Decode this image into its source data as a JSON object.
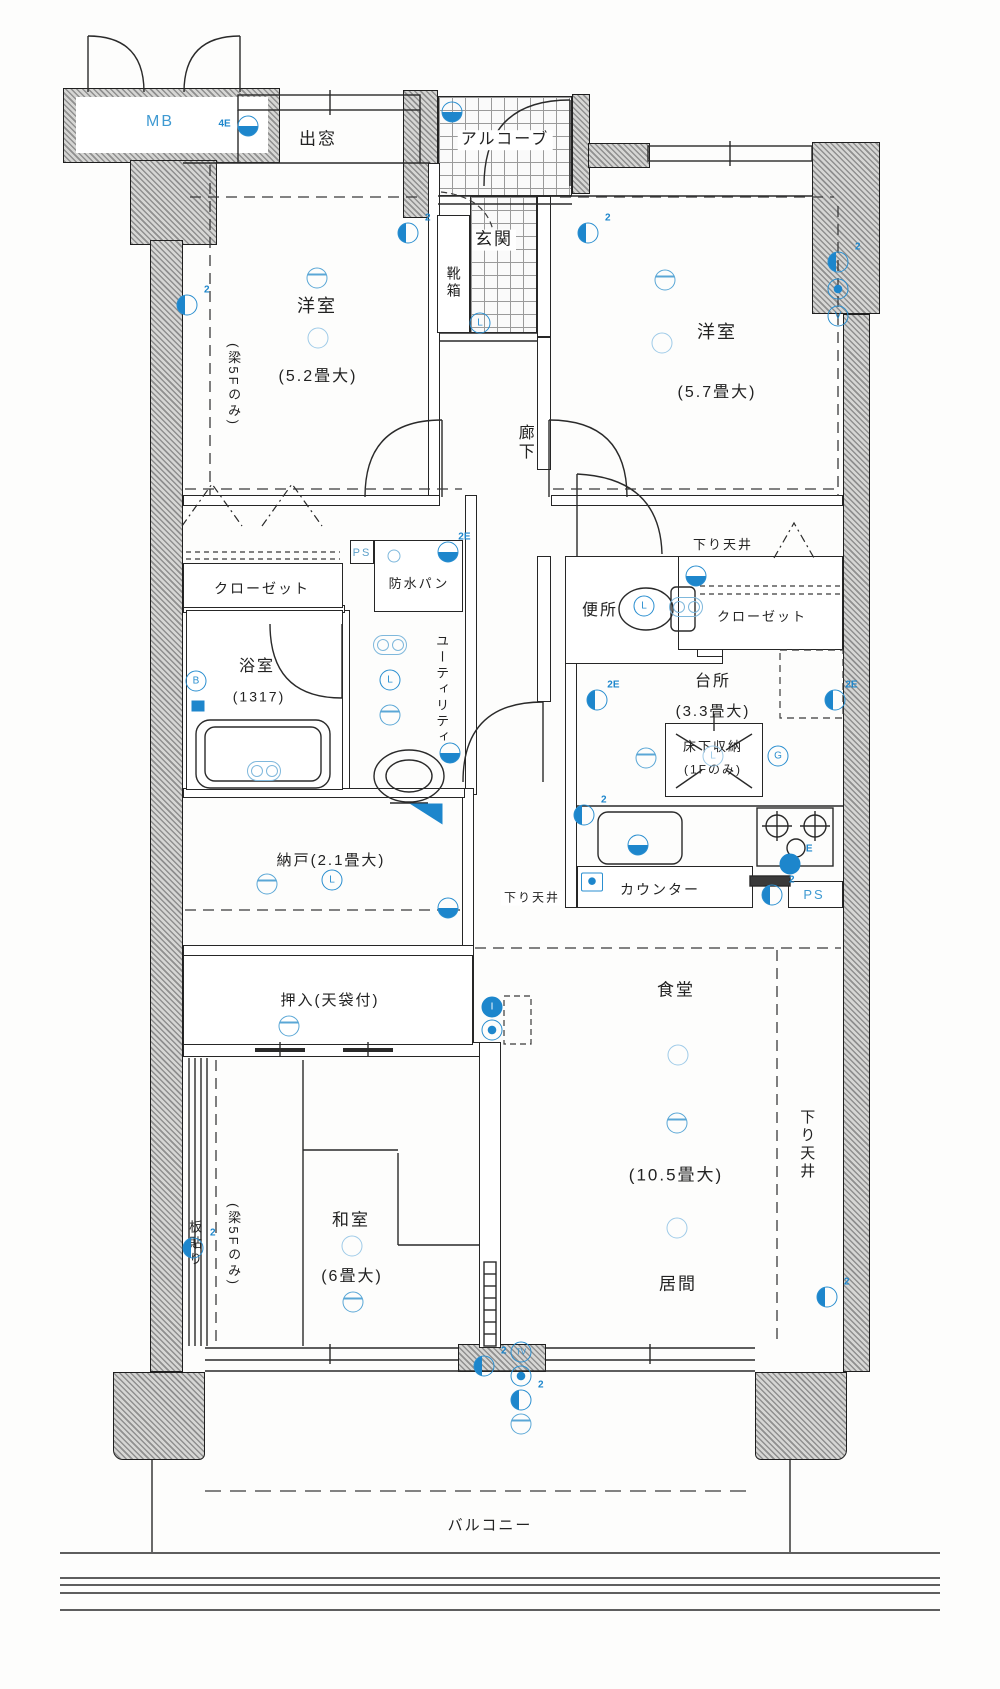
{
  "title": "マンション間取り図",
  "colors": {
    "symbol_blue": "#1d86cc",
    "light_blue": "#9fcbe8",
    "line": "#262626",
    "wall": "#8f8f8f",
    "ps_blue": "#3f9ad2"
  },
  "labels": [
    {
      "name": "label-mb",
      "text": "MB",
      "x": 160,
      "y": 122,
      "fs": 16,
      "v": false,
      "bg": false,
      "color": "#3f9ad2"
    },
    {
      "name": "label-bay-window",
      "text": "出窓",
      "x": 318,
      "y": 140,
      "fs": 17,
      "v": false,
      "bg": false,
      "color": ""
    },
    {
      "name": "label-alcove",
      "text": "アルコーブ",
      "x": 505,
      "y": 140,
      "fs": 16,
      "v": false,
      "bg": true,
      "color": ""
    },
    {
      "name": "label-genkan",
      "text": "玄関",
      "x": 494,
      "y": 240,
      "fs": 17,
      "v": false,
      "bg": true,
      "color": ""
    },
    {
      "name": "label-shoebox",
      "text": "靴箱",
      "x": 453,
      "y": 283,
      "fs": 14,
      "v": true,
      "bg": false,
      "color": ""
    },
    {
      "name": "label-western-room-1",
      "text": "洋室",
      "x": 317,
      "y": 307,
      "fs": 18,
      "v": false,
      "bg": false,
      "color": ""
    },
    {
      "name": "label-western-room-1-size",
      "text": "(5.2畳大)",
      "x": 318,
      "y": 377,
      "fs": 16,
      "v": false,
      "bg": false,
      "color": ""
    },
    {
      "name": "label-beam-5f-1",
      "text": "(梁5Fのみ)",
      "x": 233,
      "y": 385,
      "fs": 13,
      "v": true,
      "bg": false,
      "color": ""
    },
    {
      "name": "label-corridor",
      "text": "廊下",
      "x": 524,
      "y": 443,
      "fs": 16,
      "v": true,
      "bg": false,
      "color": ""
    },
    {
      "name": "label-western-room-2",
      "text": "洋室",
      "x": 717,
      "y": 333,
      "fs": 18,
      "v": false,
      "bg": false,
      "color": ""
    },
    {
      "name": "label-western-room-2-size",
      "text": "(5.7畳大)",
      "x": 717,
      "y": 393,
      "fs": 16,
      "v": false,
      "bg": false,
      "color": ""
    },
    {
      "name": "label-closet-left",
      "text": "クローゼット",
      "x": 262,
      "y": 589,
      "fs": 14,
      "v": false,
      "bg": false,
      "color": ""
    },
    {
      "name": "label-ps-1",
      "text": "PS",
      "x": 362,
      "y": 553,
      "fs": 11,
      "v": false,
      "bg": false,
      "color": "#5b9fc9"
    },
    {
      "name": "label-waterproof-pan",
      "text": "防水パン",
      "x": 419,
      "y": 584,
      "fs": 13,
      "v": false,
      "bg": true,
      "color": ""
    },
    {
      "name": "label-utility",
      "text": "ユーティリティ",
      "x": 441,
      "y": 690,
      "fs": 13,
      "v": true,
      "bg": false,
      "color": ""
    },
    {
      "name": "label-bathroom",
      "text": "浴室",
      "x": 257,
      "y": 667,
      "fs": 16,
      "v": false,
      "bg": false,
      "color": ""
    },
    {
      "name": "label-bathroom-size",
      "text": "(1317)",
      "x": 259,
      "y": 697,
      "fs": 14,
      "v": false,
      "bg": false,
      "color": ""
    },
    {
      "name": "label-toilet",
      "text": "便所",
      "x": 600,
      "y": 611,
      "fs": 16,
      "v": false,
      "bg": false,
      "color": ""
    },
    {
      "name": "label-lowered-ceiling-1",
      "text": "下り天井",
      "x": 723,
      "y": 545,
      "fs": 13,
      "v": false,
      "bg": false,
      "color": ""
    },
    {
      "name": "label-closet-right",
      "text": "クローゼット",
      "x": 762,
      "y": 617,
      "fs": 13,
      "v": false,
      "bg": false,
      "color": ""
    },
    {
      "name": "label-kitchen",
      "text": "台所",
      "x": 713,
      "y": 682,
      "fs": 16,
      "v": false,
      "bg": false,
      "color": ""
    },
    {
      "name": "label-kitchen-size",
      "text": "(3.3畳大)",
      "x": 713,
      "y": 712,
      "fs": 15,
      "v": false,
      "bg": false,
      "color": ""
    },
    {
      "name": "label-underfloor-storage",
      "text": "床下収納",
      "x": 713,
      "y": 747,
      "fs": 13,
      "v": false,
      "bg": false,
      "color": ""
    },
    {
      "name": "label-underfloor-storage-2",
      "text": "(1Fのみ)",
      "x": 713,
      "y": 770,
      "fs": 12,
      "v": false,
      "bg": false,
      "color": ""
    },
    {
      "name": "label-storeroom",
      "text": "納戸(2.1畳大)",
      "x": 331,
      "y": 861,
      "fs": 15,
      "v": false,
      "bg": false,
      "color": ""
    },
    {
      "name": "label-lowered-ceiling-2",
      "text": "下り天井",
      "x": 532,
      "y": 898,
      "fs": 12,
      "v": false,
      "bg": true,
      "color": ""
    },
    {
      "name": "label-counter",
      "text": "カウンター",
      "x": 660,
      "y": 890,
      "fs": 14,
      "v": false,
      "bg": false,
      "color": ""
    },
    {
      "name": "label-ps-2",
      "text": "PS",
      "x": 814,
      "y": 895,
      "fs": 13,
      "v": false,
      "bg": false,
      "color": "#3f9ad2"
    },
    {
      "name": "label-oshiire",
      "text": "押入(天袋付)",
      "x": 330,
      "y": 1001,
      "fs": 15,
      "v": false,
      "bg": false,
      "color": ""
    },
    {
      "name": "label-wood-floor",
      "text": "板貼り",
      "x": 194,
      "y": 1244,
      "fs": 13,
      "v": true,
      "bg": false,
      "color": ""
    },
    {
      "name": "label-beam-5f-2",
      "text": "(梁5Fのみ)",
      "x": 233,
      "y": 1245,
      "fs": 13,
      "v": true,
      "bg": false,
      "color": ""
    },
    {
      "name": "label-japanese-room",
      "text": "和室",
      "x": 351,
      "y": 1221,
      "fs": 17,
      "v": false,
      "bg": false,
      "color": ""
    },
    {
      "name": "label-japanese-room-size",
      "text": "(6畳大)",
      "x": 352,
      "y": 1277,
      "fs": 16,
      "v": false,
      "bg": false,
      "color": ""
    },
    {
      "name": "label-dining",
      "text": "食堂",
      "x": 676,
      "y": 991,
      "fs": 17,
      "v": false,
      "bg": false,
      "color": ""
    },
    {
      "name": "label-ld-size",
      "text": "(10.5畳大)",
      "x": 676,
      "y": 1176,
      "fs": 17,
      "v": false,
      "bg": false,
      "color": ""
    },
    {
      "name": "label-living",
      "text": "居間",
      "x": 678,
      "y": 1285,
      "fs": 17,
      "v": false,
      "bg": false,
      "color": ""
    },
    {
      "name": "label-lowered-ceiling-3",
      "text": "下り天井",
      "x": 806,
      "y": 1145,
      "fs": 15,
      "v": true,
      "bg": false,
      "color": ""
    },
    {
      "name": "label-balcony",
      "text": "バルコニー",
      "x": 490,
      "y": 1526,
      "fs": 15,
      "v": false,
      "bg": false,
      "color": ""
    }
  ],
  "symbols": [
    {
      "name": "mb-light-icon",
      "variant": "halffill",
      "x": 248,
      "y": 126,
      "glyph": "",
      "tag": "4E",
      "tagside": "left"
    },
    {
      "name": "alcove-light-icon",
      "variant": "halffill",
      "x": 452,
      "y": 112,
      "glyph": "",
      "tag": "",
      "tagside": ""
    },
    {
      "name": "outlet-icon",
      "variant": "outlet",
      "x": 187,
      "y": 305,
      "glyph": "",
      "tag": "2",
      "tagside": ""
    },
    {
      "name": "ceiling-light-icon",
      "variant": "light",
      "x": 317,
      "y": 278,
      "glyph": "",
      "tag": "",
      "tagside": ""
    },
    {
      "name": "lamp-icon",
      "variant": "lamp",
      "x": 318,
      "y": 338,
      "glyph": "",
      "tag": "",
      "tagside": ""
    },
    {
      "name": "outlet-icon",
      "variant": "outlet",
      "x": 408,
      "y": 233,
      "glyph": "",
      "tag": "2",
      "tagside": ""
    },
    {
      "name": "outlet-icon",
      "variant": "outlet",
      "x": 588,
      "y": 233,
      "glyph": "",
      "tag": "2",
      "tagside": ""
    },
    {
      "name": "light-switch-icon",
      "variant": "letter",
      "x": 480,
      "y": 323,
      "glyph": "L",
      "tag": "",
      "tagside": ""
    },
    {
      "name": "ceiling-light-icon",
      "variant": "light",
      "x": 665,
      "y": 280,
      "glyph": "",
      "tag": "",
      "tagside": ""
    },
    {
      "name": "lamp-icon",
      "variant": "lamp",
      "x": 662,
      "y": 343,
      "glyph": "",
      "tag": "",
      "tagside": ""
    },
    {
      "name": "outlet-icon",
      "variant": "outlet",
      "x": 838,
      "y": 262,
      "glyph": "",
      "tag": "2",
      "tagside": ""
    },
    {
      "name": "phone-jack-icon",
      "variant": "dotf",
      "x": 838,
      "y": 289,
      "glyph": "",
      "tag": "",
      "tagside": ""
    },
    {
      "name": "tv-jack-icon",
      "variant": "letter",
      "x": 838,
      "y": 316,
      "glyph": "V",
      "tag": "",
      "tagside": ""
    },
    {
      "name": "washer-faucet-icon",
      "variant": "halffill",
      "x": 448,
      "y": 552,
      "glyph": "",
      "tag": "2E",
      "tagside": ""
    },
    {
      "name": "drain-icon",
      "variant": "ring",
      "x": 394,
      "y": 556,
      "glyph": "",
      "tag": "",
      "tagside": ""
    },
    {
      "name": "fan-icon",
      "variant": "rings",
      "x": 390,
      "y": 645,
      "glyph": "",
      "tag": "",
      "tagside": ""
    },
    {
      "name": "light-switch-icon",
      "variant": "letter",
      "x": 390,
      "y": 680,
      "glyph": "L",
      "tag": "",
      "tagside": ""
    },
    {
      "name": "ceiling-light-icon",
      "variant": "light",
      "x": 390,
      "y": 715,
      "glyph": "",
      "tag": "",
      "tagside": ""
    },
    {
      "name": "outlet-icon",
      "variant": "halffill",
      "x": 450,
      "y": 753,
      "glyph": "",
      "tag": "",
      "tagside": ""
    },
    {
      "name": "bath-unit-icon",
      "variant": "letter",
      "x": 196,
      "y": 681,
      "glyph": "B",
      "tag": "",
      "tagside": ""
    },
    {
      "name": "bath-box-icon",
      "variant": "sqf",
      "x": 198,
      "y": 706,
      "glyph": "",
      "tag": "",
      "tagside": ""
    },
    {
      "name": "bath-faucet-icon",
      "variant": "rings",
      "x": 264,
      "y": 771,
      "glyph": "",
      "tag": "",
      "tagside": ""
    },
    {
      "name": "light-switch-icon",
      "variant": "letter",
      "x": 644,
      "y": 606,
      "glyph": "L",
      "tag": "",
      "tagside": ""
    },
    {
      "name": "toilet-faucet-icon",
      "variant": "rings",
      "x": 686,
      "y": 607,
      "glyph": "",
      "tag": "",
      "tagside": ""
    },
    {
      "name": "toilet-valve-icon",
      "variant": "halffill",
      "x": 696,
      "y": 576,
      "glyph": "",
      "tag": "",
      "tagside": ""
    },
    {
      "name": "outlet-icon",
      "variant": "outlet",
      "x": 597,
      "y": 700,
      "glyph": "",
      "tag": "2E",
      "tagside": ""
    },
    {
      "name": "outlet-icon",
      "variant": "outlet",
      "x": 835,
      "y": 700,
      "glyph": "",
      "tag": "2E",
      "tagside": ""
    },
    {
      "name": "gas-outlet-icon",
      "variant": "letter",
      "x": 778,
      "y": 756,
      "glyph": "G",
      "tag": "",
      "tagside": ""
    },
    {
      "name": "ceiling-light-icon",
      "variant": "light",
      "x": 646,
      "y": 758,
      "glyph": "",
      "tag": "",
      "tagside": ""
    },
    {
      "name": "light-switch-icon",
      "variant": "lamp",
      "x": 713,
      "y": 756,
      "glyph": "L",
      "tag": "",
      "tagside": ""
    },
    {
      "name": "outlet-icon",
      "variant": "outlet",
      "x": 584,
      "y": 815,
      "glyph": "",
      "tag": "2",
      "tagside": ""
    },
    {
      "name": "sink-faucet-icon",
      "variant": "halffill",
      "x": 638,
      "y": 845,
      "glyph": "",
      "tag": "",
      "tagside": ""
    },
    {
      "name": "gas-stove-icon",
      "variant": "filled",
      "x": 790,
      "y": 864,
      "glyph": "",
      "tag": "E",
      "tagside": ""
    },
    {
      "name": "counter-box-icon",
      "variant": "sqdot",
      "x": 592,
      "y": 882,
      "glyph": "",
      "tag": "",
      "tagside": ""
    },
    {
      "name": "outlet-icon",
      "variant": "outlet",
      "x": 772,
      "y": 895,
      "glyph": "",
      "tag": "2",
      "tagside": ""
    },
    {
      "name": "ceiling-light-icon",
      "variant": "light",
      "x": 267,
      "y": 884,
      "glyph": "",
      "tag": "",
      "tagside": ""
    },
    {
      "name": "light-switch-icon",
      "variant": "letter",
      "x": 332,
      "y": 880,
      "glyph": "L",
      "tag": "",
      "tagside": ""
    },
    {
      "name": "fridge-corner-icon",
      "variant": "tri",
      "x": 426,
      "y": 814,
      "glyph": "",
      "tag": "",
      "tagside": ""
    },
    {
      "name": "outlet-icon",
      "variant": "halffill",
      "x": 448,
      "y": 908,
      "glyph": "",
      "tag": "",
      "tagside": ""
    },
    {
      "name": "ceiling-light-icon",
      "variant": "light",
      "x": 289,
      "y": 1026,
      "glyph": "",
      "tag": "",
      "tagside": ""
    },
    {
      "name": "aircon-icon",
      "variant": "filled",
      "x": 492,
      "y": 1007,
      "glyph": "I",
      "tag": "",
      "tagside": ""
    },
    {
      "name": "aircon-jack-icon",
      "variant": "dotf",
      "x": 492,
      "y": 1030,
      "glyph": "",
      "tag": "",
      "tagside": ""
    },
    {
      "name": "outlet-icon",
      "variant": "outlet",
      "x": 193,
      "y": 1248,
      "glyph": "",
      "tag": "2",
      "tagside": ""
    },
    {
      "name": "lamp-icon",
      "variant": "lamp",
      "x": 352,
      "y": 1246,
      "glyph": "",
      "tag": "",
      "tagside": ""
    },
    {
      "name": "ceiling-light-icon",
      "variant": "light",
      "x": 353,
      "y": 1302,
      "glyph": "",
      "tag": "",
      "tagside": ""
    },
    {
      "name": "lamp-icon",
      "variant": "lamp",
      "x": 678,
      "y": 1055,
      "glyph": "",
      "tag": "",
      "tagside": ""
    },
    {
      "name": "ceiling-light-icon",
      "variant": "light",
      "x": 677,
      "y": 1123,
      "glyph": "",
      "tag": "",
      "tagside": ""
    },
    {
      "name": "lamp-icon",
      "variant": "lamp",
      "x": 677,
      "y": 1228,
      "glyph": "",
      "tag": "",
      "tagside": ""
    },
    {
      "name": "tv-outlet-icon",
      "variant": "letter",
      "x": 521,
      "y": 1352,
      "glyph": "TV",
      "tag": "",
      "tagside": ""
    },
    {
      "name": "phone-jack-icon",
      "variant": "dotf",
      "x": 521,
      "y": 1376,
      "glyph": "",
      "tag": "",
      "tagside": ""
    },
    {
      "name": "outlet-icon",
      "variant": "outlet",
      "x": 521,
      "y": 1400,
      "glyph": "",
      "tag": "2",
      "tagside": ""
    },
    {
      "name": "ceiling-light-icon",
      "variant": "light",
      "x": 521,
      "y": 1424,
      "glyph": "",
      "tag": "",
      "tagside": ""
    },
    {
      "name": "outlet-icon",
      "variant": "outlet",
      "x": 484,
      "y": 1366,
      "glyph": "",
      "tag": "2",
      "tagside": ""
    },
    {
      "name": "outlet-icon",
      "variant": "outlet",
      "x": 827,
      "y": 1297,
      "glyph": "",
      "tag": "2",
      "tagside": ""
    }
  ]
}
